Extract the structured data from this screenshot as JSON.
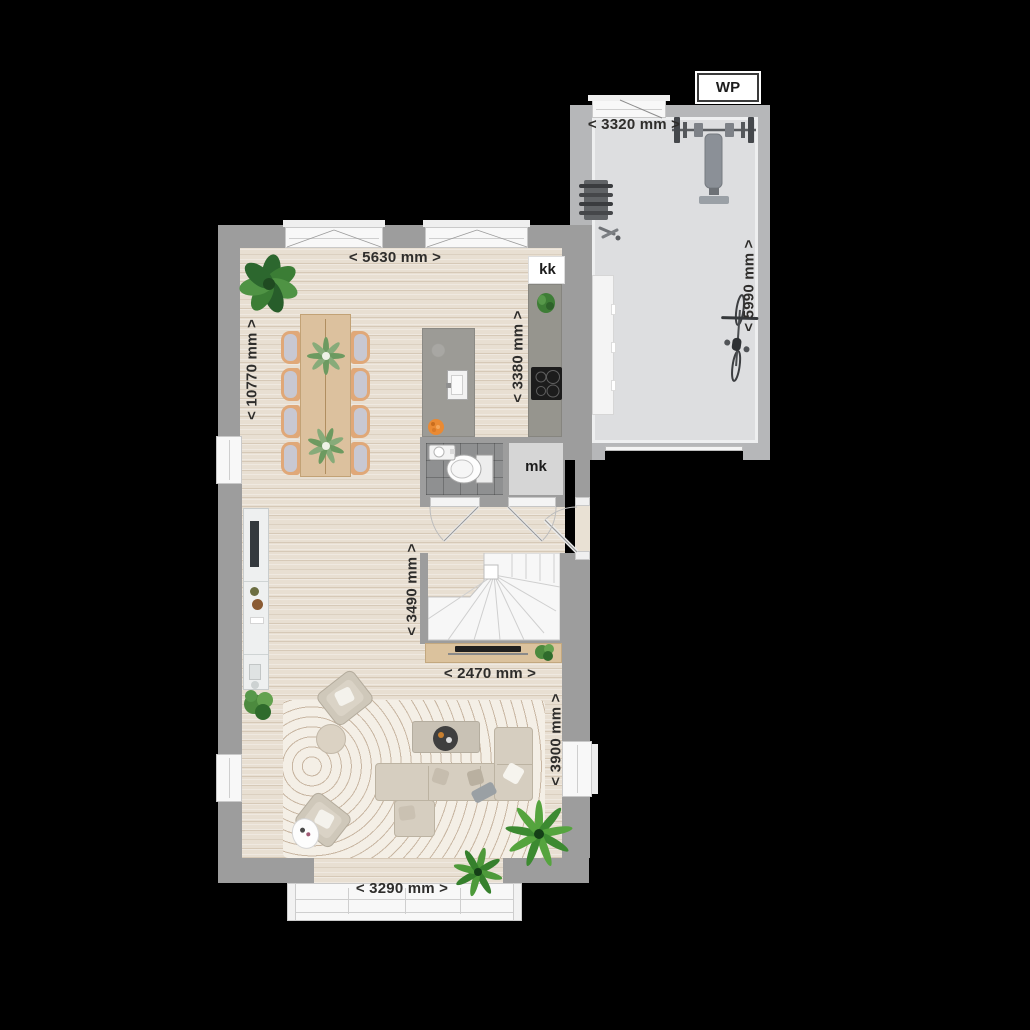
{
  "labels": {
    "heat_pump": "WP",
    "kitchenette": "kk",
    "meter_cupboard": "mk"
  },
  "dimensions": {
    "house_width_top": "< 5630 mm >",
    "house_depth_left": "< 10770 mm >",
    "kitchen_depth": "< 3380 mm >",
    "hall_depth": "< 3490 mm >",
    "stair_width": "< 2470 mm >",
    "living_depth": "< 3900 mm >",
    "bay_width": "< 3290 mm >",
    "garage_width": "< 3320 mm >",
    "garage_depth": "< 5990 mm >"
  },
  "colors": {
    "background": "#000000",
    "house_wall": "#9d9d9d",
    "garage_wall": "#b6b7b9",
    "wood_floor": "#e8dfd2",
    "garage_floor": "#dddee0",
    "tile_floor": "#8f9091",
    "rug": "#f4efe6",
    "counter_concrete": "#9c9b96",
    "table_wood": "#dcc19e",
    "plant_green": "#4e9140",
    "fruit_accent": "#ea8a33"
  }
}
